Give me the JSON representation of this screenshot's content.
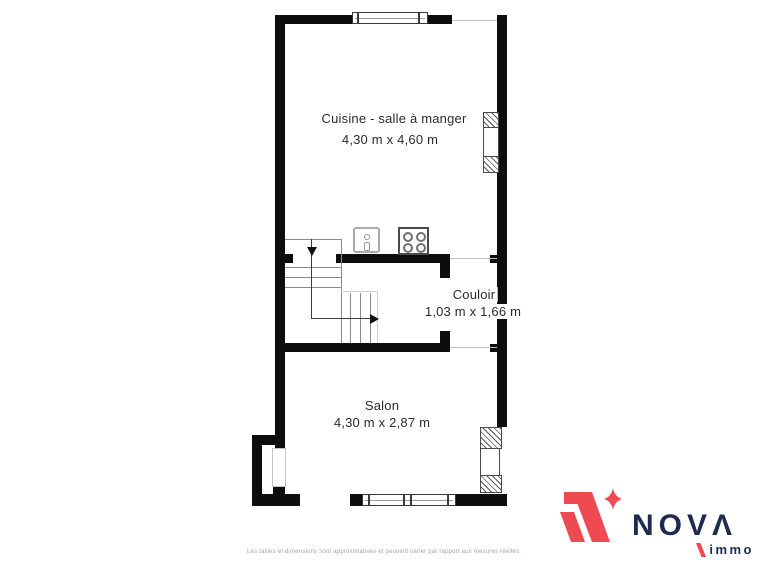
{
  "floor_plan": {
    "rooms": [
      {
        "name": "Cuisine - salle à manger",
        "dimensions": "4,30 m x 4,60 m"
      },
      {
        "name": "Couloir",
        "dimensions": "1,03 m x 1,66 m"
      },
      {
        "name": "Salon",
        "dimensions": "4,30 m x 2,87 m"
      }
    ],
    "symbols": {
      "staircase": "l-shaped-stairs-with-direction-arrows",
      "sink": "square-sink-with-faucet",
      "stove": "four-burner-stove",
      "window": "double-line-window",
      "shutter": "hatched-shutter-panels"
    }
  },
  "footer": {
    "disclaimer": "Les tailles et dimensions sont approximatives et peuvent varier par rapport aux mesures réelles."
  },
  "logo": {
    "brand": "NOVΛ",
    "subtitle": "immo"
  },
  "colors": {
    "wall": "#0d0d0d",
    "background": "#ffffff",
    "stair_lines": "#8a8a8a",
    "label_text": "#2b2b2b",
    "disclaimer_text": "#a3a3a3",
    "brand_red": "#ee4a52",
    "brand_navy": "#1d2b50"
  }
}
